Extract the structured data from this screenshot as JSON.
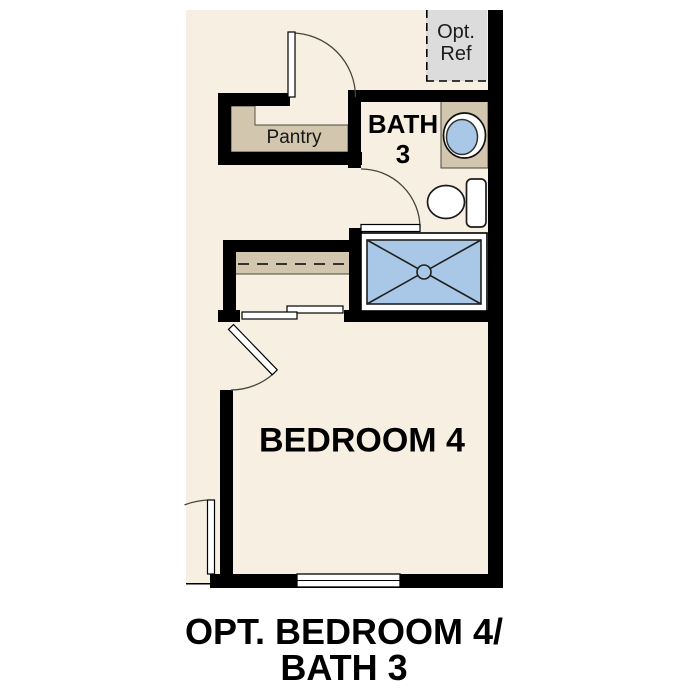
{
  "diagram": {
    "type": "floor-plan",
    "rooms": {
      "pantry": {
        "label": "Pantry"
      },
      "bath": {
        "line1": "BATH",
        "line2": "3"
      },
      "bedroom": {
        "label": "BEDROOM 4"
      },
      "opt_ref": {
        "line1": "Opt.",
        "line2": "Ref"
      }
    },
    "caption": {
      "line1": "OPT. BEDROOM 4/",
      "line2": "BATH 3"
    },
    "fixtures": [
      "shower-pan",
      "toilet",
      "vanity-sink",
      "vanity-counter",
      "closet-rod",
      "pantry-shelving",
      "optional-refrigerator",
      "window",
      "hinged-doors",
      "bypass-closet-doors"
    ],
    "colors": {
      "floor": "#f7efe2",
      "wall": "#000000",
      "tan": "#d2c6ae",
      "blue": "#a9c8e7",
      "gray": "#dcdcdc",
      "line": "#45453c",
      "edge": "#4a453e",
      "text": "#000000"
    }
  }
}
